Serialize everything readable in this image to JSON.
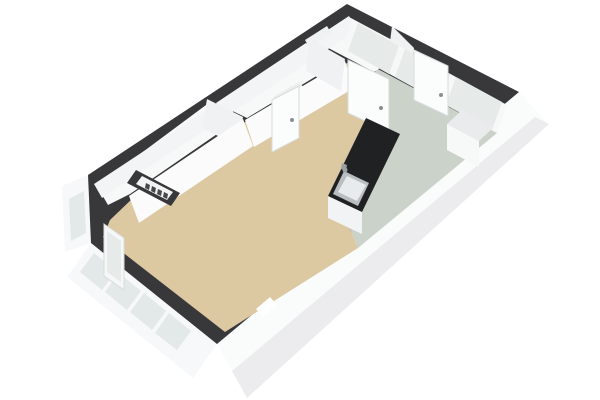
{
  "view": {
    "description": "isometric-3d-floorplan",
    "canvas": {
      "width": 600,
      "height": 400
    },
    "background": "#ffffff"
  },
  "colors": {
    "wall_top": "#38383a",
    "wall_face_white": "#fafbfb",
    "wall_face_shade": "#ececee",
    "floor_living": "#dcc8a1",
    "floor_kitchen": "#cbd2ca",
    "floor_room_white": "#f7f8f8",
    "glass": "#e3e8e9",
    "counter_top": "#202122",
    "sink_steel": "#b9bec0",
    "door_leaf": "#fbfcfc",
    "handle": "#8a8f91"
  },
  "rooms": [
    {
      "name": "living-room",
      "floor": "beige"
    },
    {
      "name": "kitchen",
      "floor": "gray-green"
    },
    {
      "name": "bathroom",
      "floor": "white"
    },
    {
      "name": "corridor",
      "floor": "white"
    },
    {
      "name": "entrance-hall",
      "floor": "white"
    }
  ],
  "fixtures": [
    "kitchen-counter",
    "kitchen-sink",
    "faucet",
    "radiator-niche",
    "interior-doors",
    "sliding-glass-doors",
    "facade-windows"
  ],
  "scene": {
    "polygons": [
      {
        "name": "exterior-face-bottom-right",
        "fill": "#fafbfb",
        "points": "217,344 519,92 549,124 247,398"
      },
      {
        "name": "exterior-face-bottom-right-shade",
        "fill": "#ececee",
        "points": "232,371 535,117 549,124 247,398"
      },
      {
        "name": "exterior-face-lower-left",
        "fill": "#f7f8f9",
        "points": "91,243 217,344 193,378 67,277"
      },
      {
        "name": "facade-window-pane",
        "fill": "#e3e8e9",
        "points": "94,253 116,271 102,290 80,272"
      },
      {
        "name": "facade-window-pane",
        "fill": "#e3e8e9",
        "points": "119,273 141,291 127,310 105,292"
      },
      {
        "name": "facade-window-pane",
        "fill": "#e3e8e9",
        "points": "144,293 166,311 152,330 130,312"
      },
      {
        "name": "facade-window-pane",
        "fill": "#e3e8e9",
        "points": "169,313 191,331 177,350 155,333"
      },
      {
        "name": "exterior-face-left",
        "fill": "#f7f8f9",
        "points": "88,175 91,243 65,252 62,186"
      },
      {
        "name": "facade-window-pane-left",
        "fill": "#e3e8e9",
        "points": "84,191 86,233 71,241 69,199"
      },
      {
        "name": "wall-footprint",
        "fill": "#38383a",
        "points": "347,4 519,92 217,344 91,243 88,175"
      },
      {
        "name": "living-room-floor",
        "fill": "#dcc8a1",
        "points": "245,122 347,63 372,76 366,120 334,190 358,248 225,332 103,237 110,220 133,198"
      },
      {
        "name": "kitchen-floor",
        "fill": "#cbd2ca",
        "points": "376,68 497,133 358,248 334,190 366,120"
      },
      {
        "name": "bathroom-floor",
        "fill": "#f7f8f8",
        "points": "97,186 206,105 236,121 130,194 108,205"
      },
      {
        "name": "corridor-floor",
        "fill": "#f7f8f8",
        "points": "216,103 306,43 338,63 247,118"
      },
      {
        "name": "hall-floor",
        "fill": "#f7f8f8",
        "points": "313,40 349,17 409,49 374,72"
      },
      {
        "name": "door-opening-bathroom",
        "fill": "#ededee",
        "points": "231,125 220,132 226,141 237,133"
      },
      {
        "name": "door-opening-corridor",
        "fill": "#ededee",
        "points": "273,97 299,82 305,89 279,104"
      },
      {
        "name": "wall-notch-bottom-right",
        "fill": "#ffffff",
        "points": "256,309 270,297 277,305 263,317"
      },
      {
        "name": "wall-inner-strip-top-left",
        "fill": "#f3f4f5",
        "points": "94,184 349,16 357,30 102,198"
      },
      {
        "name": "transom-window",
        "fill": "#eef2f1",
        "points": "305,40 327,26 331,33 309,47"
      },
      {
        "name": "wall-face-w1",
        "fill": "#f0f1f2",
        "points": "207,99 243,117 238,146 202,128"
      },
      {
        "name": "wall-face-w2",
        "fill": "#fbfbfc",
        "points": "243,119 129,196 139,223 253,146"
      },
      {
        "name": "wall-face-w4",
        "fill": "#fbfbfc",
        "points": "345,61 245,120 254,147 354,88"
      },
      {
        "name": "wall-face-w3",
        "fill": "#f0f1f2",
        "points": "310,39 345,59 341,91 306,71"
      },
      {
        "name": "wall-face-w5",
        "fill": "#f0f1f2",
        "points": "392,26 414,48 410,80 388,58"
      },
      {
        "name": "radiator-niche-walls",
        "fill": "#38383a",
        "points": "136,170 180,193 171,206 127,183"
      },
      {
        "name": "radiator-niche-inner",
        "fill": "#f2f3f3",
        "points": "142,176 173,192 167,200 136,184"
      },
      {
        "name": "radiator-fin",
        "fill": "#46484a",
        "points": "146,183 150,185 149,190 145,188"
      },
      {
        "name": "radiator-fin",
        "fill": "#46484a",
        "points": "152,186 156,188 155,193 151,191"
      },
      {
        "name": "radiator-fin",
        "fill": "#46484a",
        "points": "158,189 162,191 161,196 157,194"
      },
      {
        "name": "radiator-fin",
        "fill": "#46484a",
        "points": "164,192 168,194 167,199 163,197"
      },
      {
        "name": "wall-face-top-right-glazing",
        "fill": "#f6f7f7",
        "points": "352,20 507,105 497,133 342,48"
      },
      {
        "name": "sliding-door-pane",
        "fill": "#e6ebea",
        "points": "358,23 399,46 389,74 348,51"
      },
      {
        "name": "sliding-door-pane",
        "fill": "#e6ebea",
        "points": "405,49 450,74 440,102 395,77"
      },
      {
        "name": "sliding-door-pane",
        "fill": "#e6ebea",
        "points": "456,77 502,102 492,130 446,105"
      },
      {
        "name": "door-leaf-kitchen",
        "fill": "#fbfcfc",
        "stroke": "#d9dcdd",
        "points": "414,50 448,66 448,116 414,100"
      },
      {
        "name": "door-leaf-hall",
        "fill": "#fbfcfc",
        "stroke": "#d9dcdd",
        "points": "348,60 389,79 389,132 348,113"
      },
      {
        "name": "door-leaf-corridor",
        "fill": "#fbfcfc",
        "stroke": "#d9dcdd",
        "points": "272,100 299,86 299,138 272,152"
      },
      {
        "name": "door-leaf-left",
        "fill": "#f6f8f8",
        "stroke": "#d9dcdd",
        "points": "104,224 124,238 124,290 104,276"
      },
      {
        "name": "door-left-glass",
        "fill": "#e6ebea",
        "points": "107,231 121,241 121,282 107,272"
      },
      {
        "name": "kitchen-counter-front",
        "fill": "#fafbfb",
        "points": "366,118 328,196 328,218 366,140"
      },
      {
        "name": "kitchen-counter-side",
        "fill": "#f2f3f4",
        "points": "328,196 362,212 362,234 328,218"
      },
      {
        "name": "kitchen-counter-top",
        "fill": "#202122",
        "points": "366,118 400,134 362,212 328,196"
      },
      {
        "name": "kitchen-sink-rim",
        "fill": "#b9bec0",
        "points": "344,171 369,183 358,206 333,194"
      },
      {
        "name": "kitchen-sink-basin",
        "fill": "#e8ebeb",
        "points": "347,176 366,185 357,201 338,192"
      },
      {
        "name": "faucet-stem",
        "fill": "#9ba0a2",
        "points": "342,163 347,165 346,171 341,169"
      },
      {
        "name": "kitchen-corner-cabinet-top",
        "fill": "#eaebec",
        "points": "462,110 494,127 479,141 447,124"
      },
      {
        "name": "kitchen-corner-cabinet-front",
        "fill": "#f7f8f8",
        "points": "447,124 479,141 479,167 447,150"
      }
    ],
    "circles": [
      {
        "name": "faucet-head",
        "cx": 345,
        "cy": 170,
        "r": 2.5,
        "fill": "#9ba0a2"
      },
      {
        "name": "door-handle",
        "cx": 292,
        "cy": 120,
        "r": 2,
        "fill": "#8a8f91"
      },
      {
        "name": "door-handle",
        "cx": 381,
        "cy": 108,
        "r": 2,
        "fill": "#8a8f91"
      },
      {
        "name": "door-handle",
        "cx": 441,
        "cy": 95,
        "r": 2,
        "fill": "#8a8f91"
      }
    ]
  }
}
